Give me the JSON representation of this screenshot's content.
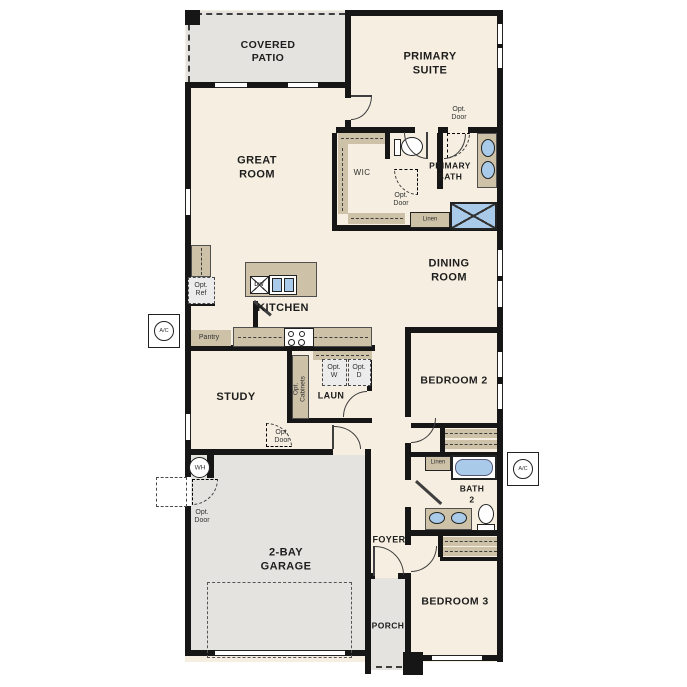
{
  "type": "residential-floor-plan",
  "colors": {
    "wall": "#161616",
    "floor": "#f6efe1",
    "patio_garage_porch": "#e4e3e0",
    "cabinet_tan": "#cdc1a7",
    "fixture_blue": "#a9cbe9",
    "optional_item_fill": "#ececec"
  },
  "labels": {
    "covered_patio": "COVERED\nPATIO",
    "primary_suite": "PRIMARY\nSUITE",
    "great_room": "GREAT\nROOM",
    "dining_room": "DINING\nROOM",
    "kitchen": "KITCHEN",
    "study": "STUDY",
    "laundry": "LAUN",
    "bedroom2": "BEDROOM 2",
    "bedroom3": "BEDROOM 3",
    "garage": "2-BAY\nGARAGE",
    "foyer": "FOYER",
    "porch": "PORCH",
    "primary_bath": "PRIMARY\nBATH",
    "bath2": "BATH\n2",
    "wic": "WIC",
    "pantry": "Pantry",
    "linen": "Linen",
    "opt_door": "Opt.\nDoor",
    "opt_ref": "Opt.\nRef",
    "opt_w": "Opt.\nW",
    "opt_d": "Opt.\nD",
    "opt_cabinets": "Opt.\nCabinets",
    "dw": "DW",
    "wh": "WH",
    "ac": "A/C"
  }
}
